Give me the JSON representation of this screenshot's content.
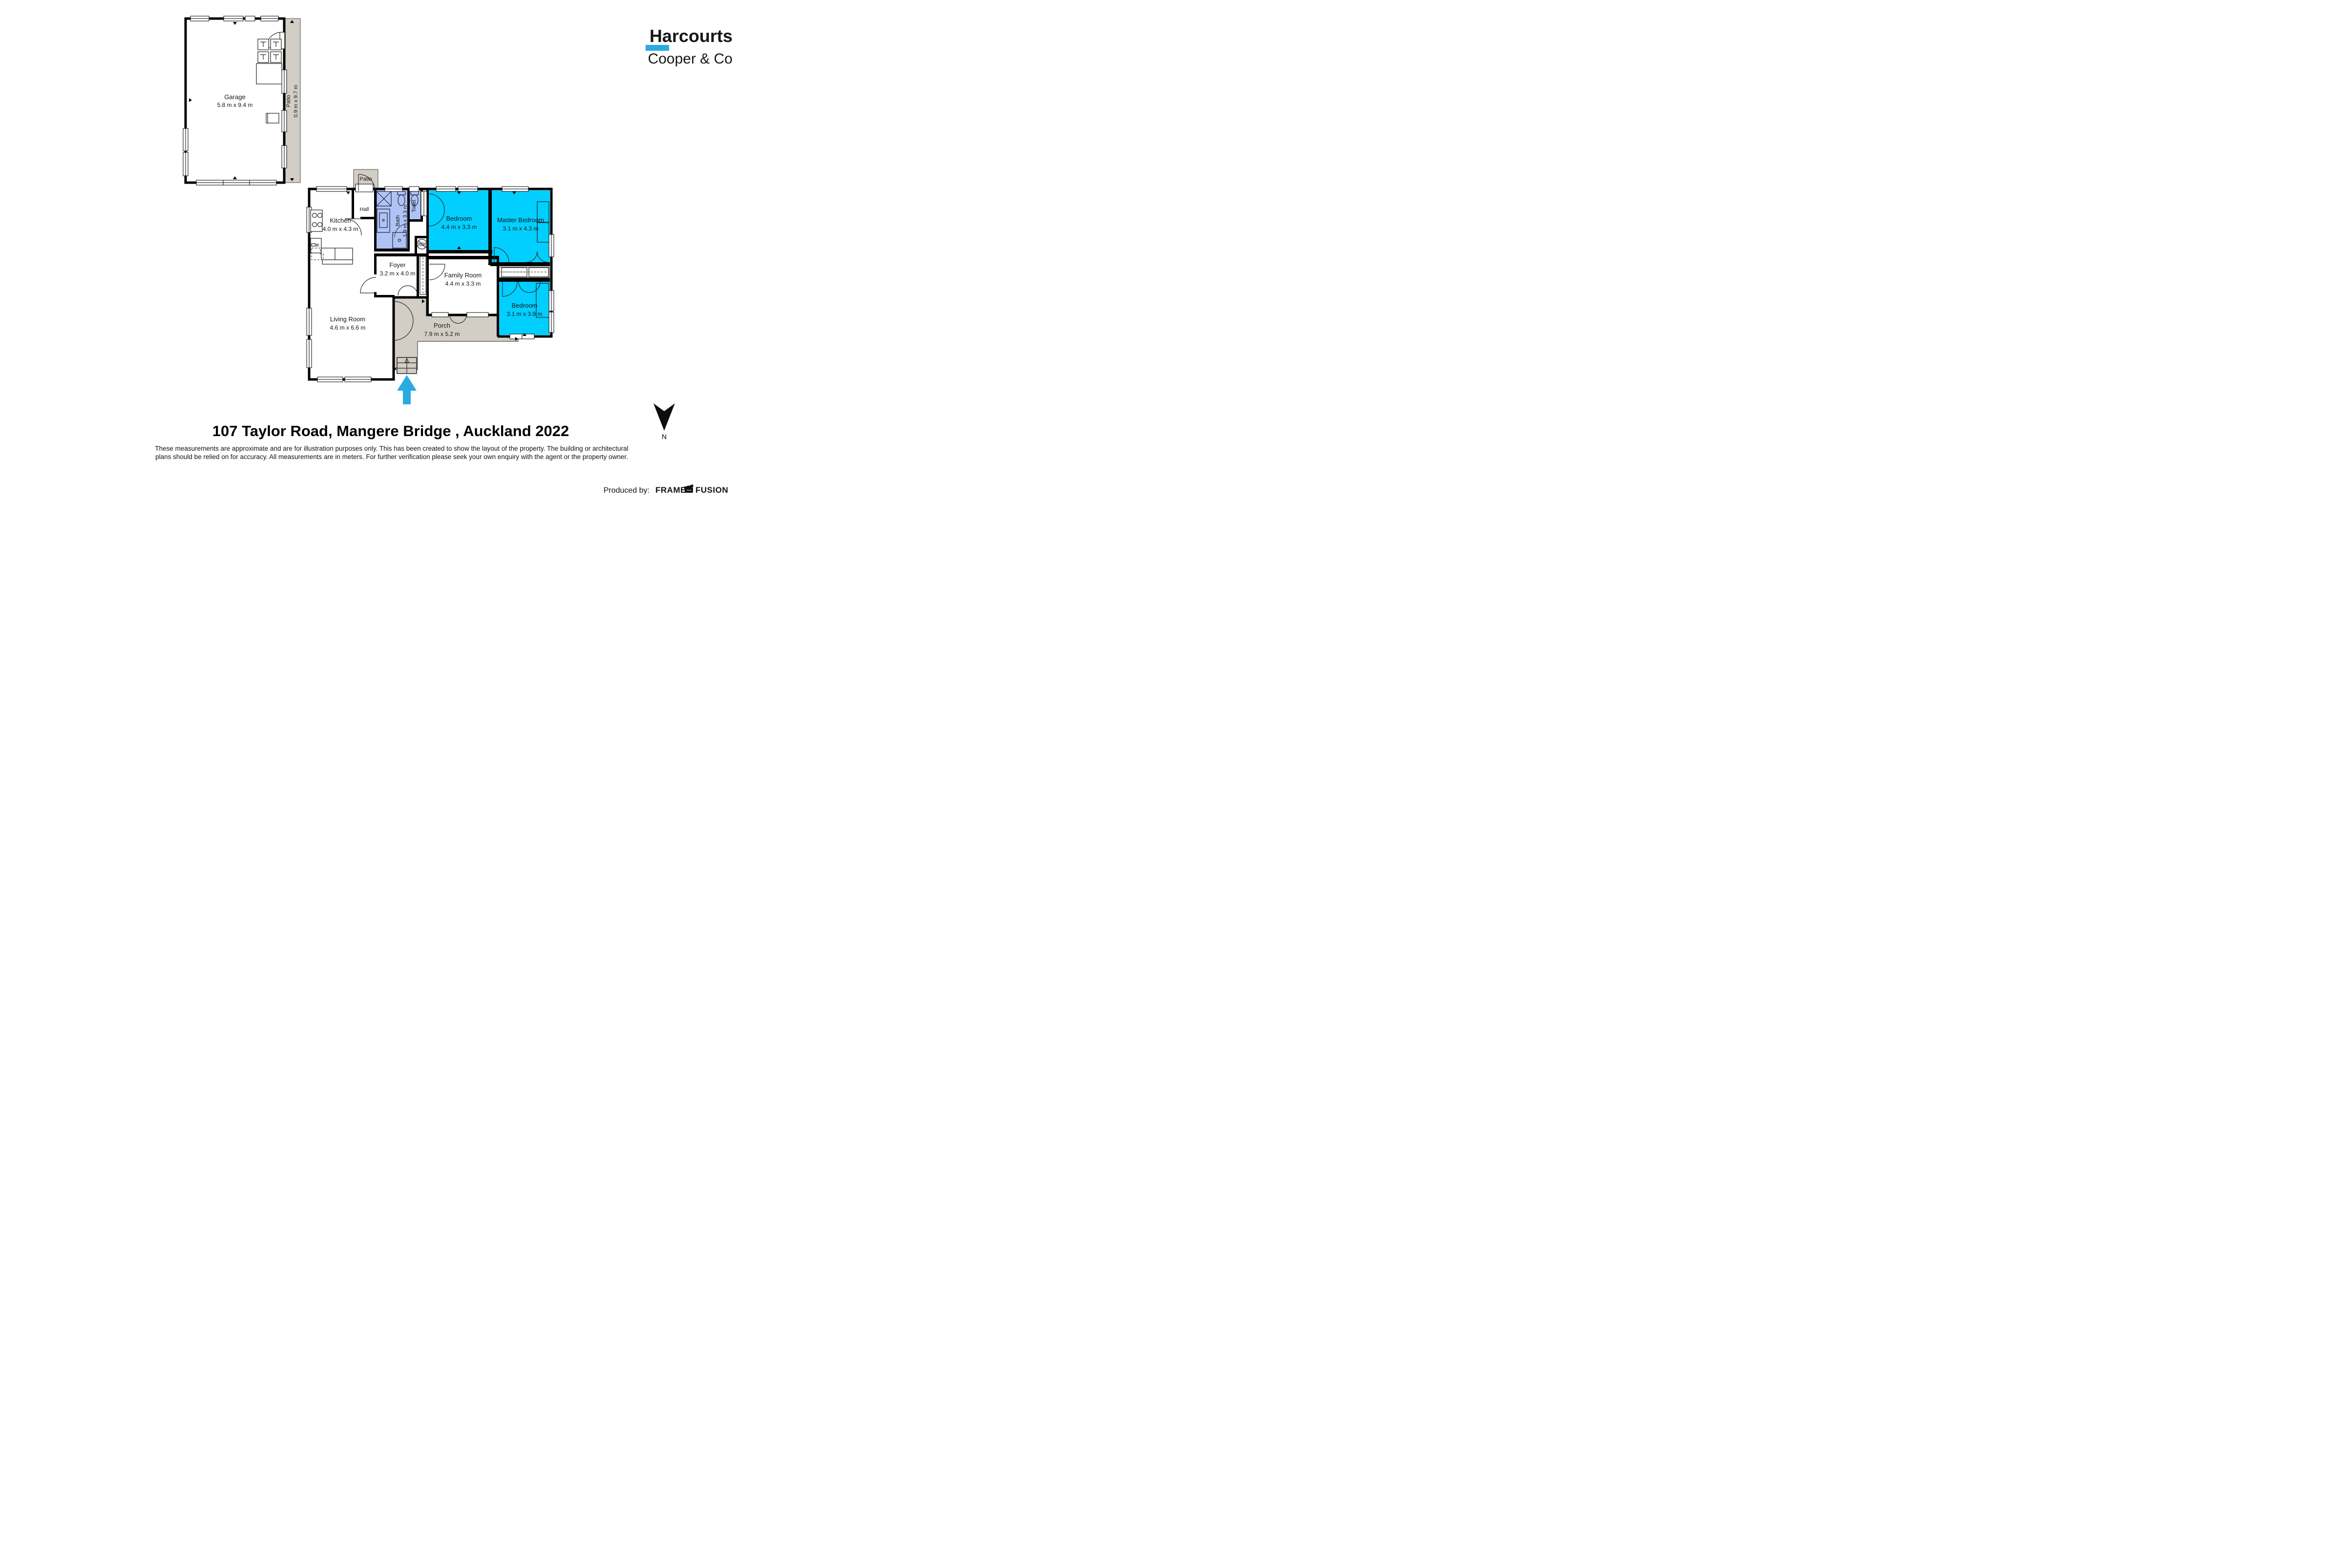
{
  "branding": {
    "line1": "Harcourts",
    "line2": "Cooper & Co"
  },
  "title": "107 Taylor Road, Mangere Bridge , Auckland 2022",
  "disclaimer_line1": "These measurements are approximate and are for illustration purposes only. This has been created to show the layout of the property. The building or architectural",
  "disclaimer_line2": "plans should be relied on for accuracy. All measurements are in meters. For further verification please seek your own enquiry with the agent or the property owner.",
  "credits": {
    "produced_by": "Produced by:",
    "producer_word1": "FRAME",
    "producer_word2": "FUSION"
  },
  "compass": {
    "label": "N"
  },
  "rooms": {
    "garage": {
      "name": "Garage",
      "dims": "5.8 m x 9.4 m"
    },
    "garage_patio": {
      "name": "Patio",
      "dims": "0.9 m x 9.7 m"
    },
    "patio": {
      "name": "Patio"
    },
    "hall": {
      "name": "Hall"
    },
    "kitchen": {
      "name": "Kitchen",
      "dims": "4.0 m x 4.3 m"
    },
    "bath": {
      "name": "Bath",
      "dims": "1.9 m x 3.3 m"
    },
    "toilet": {
      "name": "Toilet"
    },
    "utility": {
      "name": "Utility"
    },
    "bedroom1": {
      "name": "Bedroom",
      "dims": "4.4 m x 3.3 m"
    },
    "master": {
      "name": "Master Bedroom",
      "dims": "3.1 m x 4.3 m"
    },
    "foyer": {
      "name": "Foyer",
      "dims": "3.2 m x 4.0 m"
    },
    "family": {
      "name": "Family Room",
      "dims": "4.4 m x 3.3 m"
    },
    "living": {
      "name": "Living Room",
      "dims": "4.6 m x 6.6 m"
    },
    "bedroom2": {
      "name": "Bedroom",
      "dims": "3.1 m x 3.9 m"
    },
    "porch": {
      "name": "Porch",
      "dims": "7.9 m x 5.2 m"
    }
  },
  "colors": {
    "bedroom_fill": "#00cfff",
    "wet_room_fill": "#afc4f5",
    "outdoor_fill": "#d2cdc5",
    "wall": "#000000",
    "accent_blue": "#29abe2",
    "brand_navy": "#1a2a56",
    "brand_blue": "#29a9e3"
  }
}
